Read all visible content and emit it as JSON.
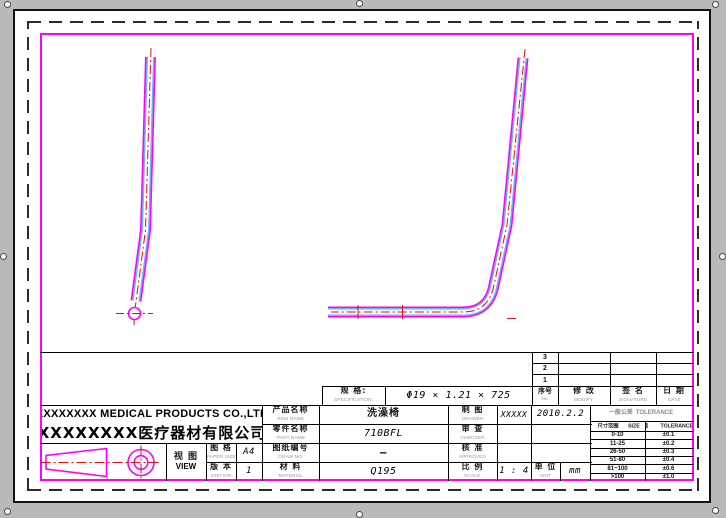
{
  "colors": {
    "frame": "#ff00ff",
    "tube_outer": "#ff00ff",
    "tube_inner": "#6cb4ff",
    "centerline_red": "#dd1111",
    "paper": "#ffffff",
    "window_bg": "#b9b9b9",
    "line": "#000000"
  },
  "company": {
    "name_en": "XXXXXXXX MEDICAL PRODUCTS CO.,LTD",
    "name_cn": "XXXXXXXX医疗器材有限公司"
  },
  "view_block": {
    "view_cn": "视 图",
    "view_en": "VIEW",
    "paper_size_cn": "图  格",
    "paper_size_en": "PAPER SIZE",
    "paper_size_value": "A4",
    "edition_cn": "版  本",
    "edition_en": "EDITION",
    "edition_value": "1"
  },
  "spec": {
    "label_cn": "规    格:",
    "label_en": "SPECIFICATION:",
    "value": "Φ19 × 1.21 × 725"
  },
  "fields": {
    "item": {
      "cn": "产品名称",
      "en": "ITEM NAME",
      "value": "洗澡椅"
    },
    "part": {
      "cn": "零件名称",
      "en": "PART NAME",
      "value": "710BFL"
    },
    "draw_no": {
      "cn": "图纸编号",
      "en": "DRAW  NO",
      "value": "—"
    },
    "material": {
      "cn": "材 料",
      "en": "MATERIAL",
      "value": "Q195"
    }
  },
  "approval": {
    "drawer": {
      "cn": "制 图",
      "en": "DRAWER",
      "name": "XXXXX",
      "date": "2010.2.2"
    },
    "checker": {
      "cn": "审 查",
      "en": "CHECKER",
      "name": "",
      "date": ""
    },
    "approved": {
      "cn": "核 准",
      "en": "APPROVED",
      "name": "",
      "date": ""
    },
    "scale": {
      "cn": "比 例",
      "en": "SCALE",
      "value": "1 : 4"
    },
    "unit": {
      "cn": "单 位",
      "en": "UNIT",
      "value": "mm"
    }
  },
  "revision": {
    "rows": [
      "3",
      "2",
      "1"
    ],
    "no": {
      "cn": "序号",
      "en": "No."
    },
    "modify": {
      "cn": "修  改",
      "en": "MODIFY"
    },
    "signature": {
      "cn": "签  名",
      "en": "SIGNATURE"
    },
    "date": {
      "cn": "日 期",
      "en": "DATE"
    }
  },
  "tolerance": {
    "title_cn": "一般公差",
    "title_en": "TOLERANCE",
    "size_cn": "尺寸范围",
    "size_en": "SIZE",
    "tol_cn": "公差",
    "tol_en": "TOLERANCE",
    "rows": [
      [
        "0-10",
        "±0.1"
      ],
      [
        "11-25",
        "±0.2"
      ],
      [
        "26-50",
        "±0.3"
      ],
      [
        "51-80",
        "±0.4"
      ],
      [
        "81~100",
        "±0.6"
      ],
      [
        ">100",
        "±1.0"
      ]
    ]
  }
}
